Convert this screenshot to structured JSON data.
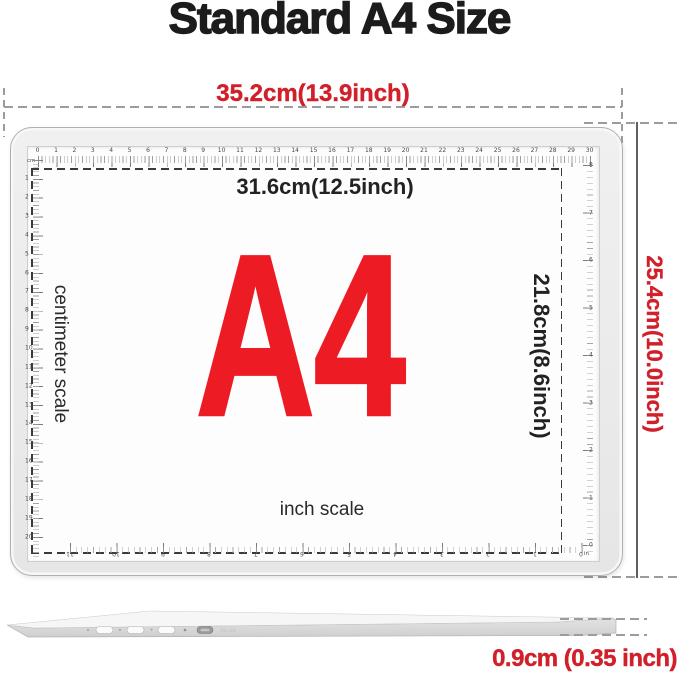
{
  "title": "Standard A4 Size",
  "colors": {
    "dimension_red": "#d1202a",
    "a4_red": "#ed1b24",
    "ink": "#1c1c1c",
    "tablet_gray": "#ebebeb"
  },
  "dimensions": {
    "outer_width": "35.2cm(13.9inch)",
    "outer_height": "25.4cm(10.0inch)",
    "thickness": "0.9cm (0.35 inch)",
    "inner_width": "31.6cm(12.5inch)",
    "inner_height": "21.8cm(8.6inch)"
  },
  "pad": {
    "size_label": "A4",
    "left_scale_label": "centimeter scale",
    "bottom_scale_label": "inch scale"
  },
  "rulers": {
    "top_cm": {
      "unit": "cm",
      "min": 0,
      "max": 30
    },
    "left_cm": {
      "min": 1,
      "max": 20
    },
    "right_in": {
      "unit": "in",
      "min": 0,
      "max": 8
    },
    "bottom_in": {
      "min": 0,
      "max": 11
    }
  },
  "side_view": {
    "port_label": "5V=2A"
  }
}
